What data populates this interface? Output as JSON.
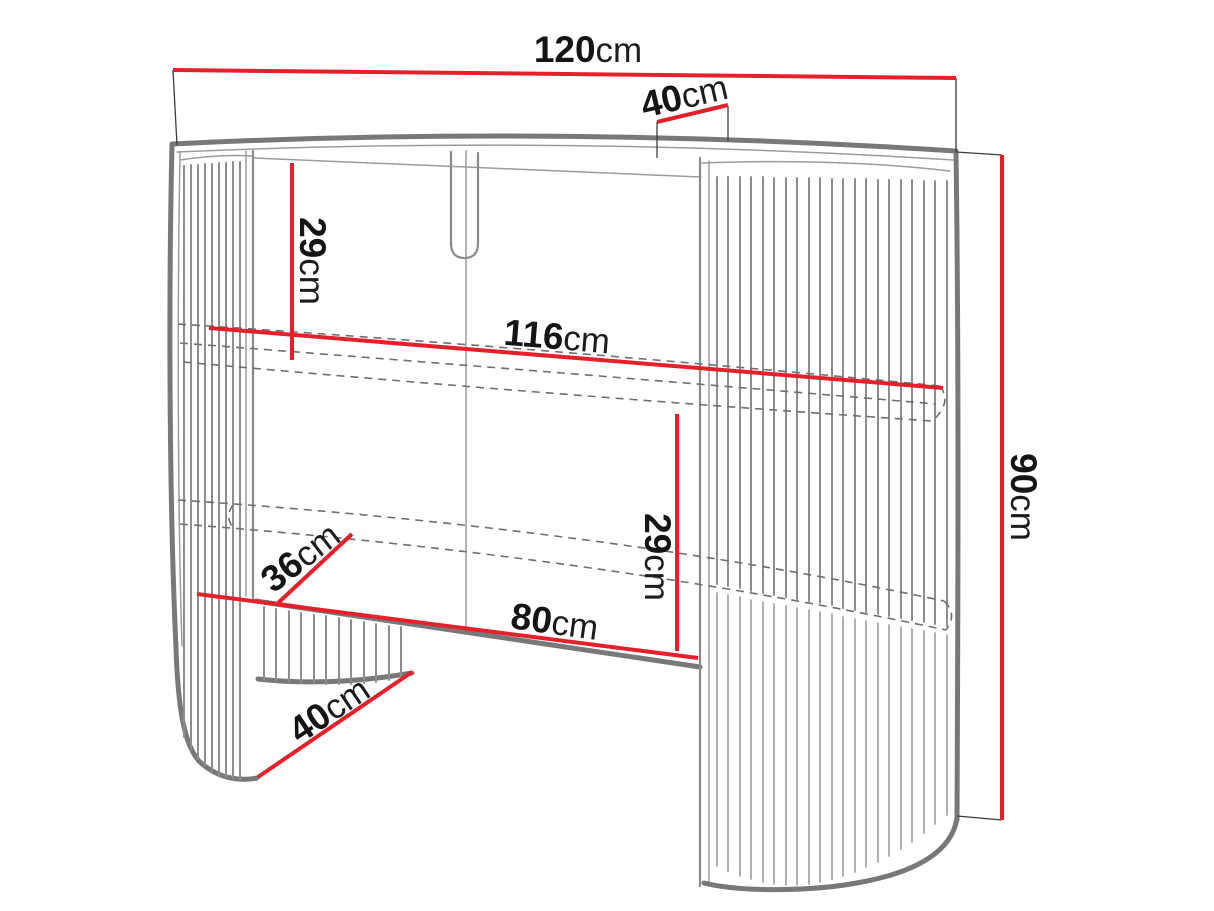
{
  "dims": {
    "top_width": {
      "value": "120",
      "unit": "cm"
    },
    "top_depth": {
      "value": "40",
      "unit": "cm"
    },
    "shelf_height": {
      "value": "29",
      "unit": "cm"
    },
    "shelf_width": {
      "value": "116",
      "unit": "cm"
    },
    "niche_height": {
      "value": "29",
      "unit": "cm"
    },
    "shelf_depth": {
      "value": "36",
      "unit": "cm"
    },
    "niche_width": {
      "value": "80",
      "unit": "cm"
    },
    "base_depth": {
      "value": "40",
      "unit": "cm"
    },
    "overall_height": {
      "value": "90",
      "unit": "cm"
    }
  },
  "colors": {
    "dimension_red": "#e4212b",
    "outline_gray": "#787878",
    "background": "#ffffff"
  }
}
